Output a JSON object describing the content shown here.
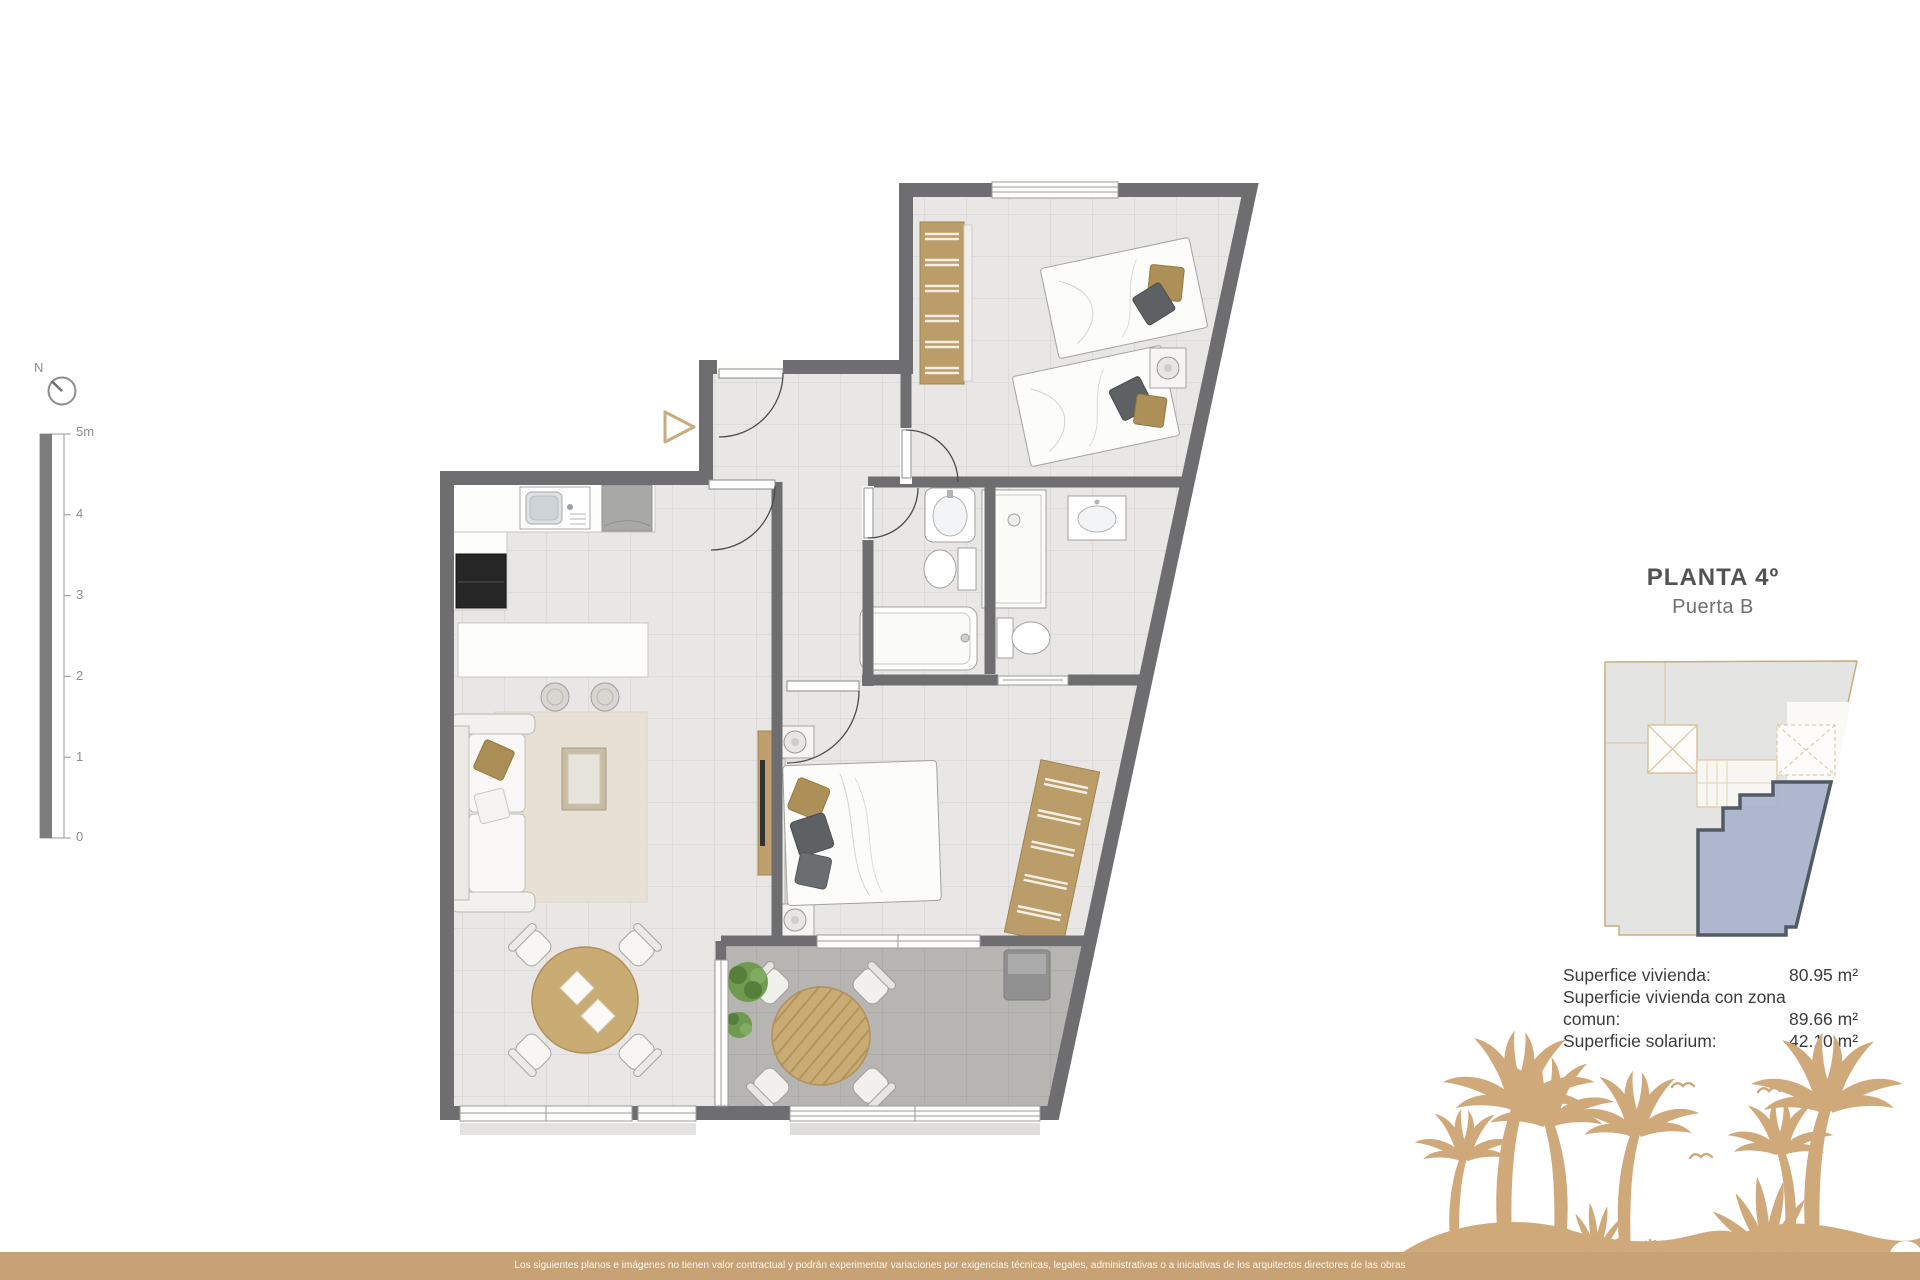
{
  "compass": {
    "label": "N"
  },
  "scale_bar": {
    "labels": [
      "5m",
      "4",
      "3",
      "2",
      "1",
      "0"
    ]
  },
  "plan_header": {
    "title": "PLANTA 4º",
    "subtitle": "Puerta B"
  },
  "areas": {
    "rows": [
      {
        "label": "Superfice vivienda:",
        "value": "80.95 m²"
      },
      {
        "label": "Superficie vivienda con zona comun:",
        "value": "89.66 m²"
      },
      {
        "label": "Superficie solarium:",
        "value": "42.10 m²"
      }
    ]
  },
  "footer": {
    "disclaimer": "Los siguientes planos e imágenes no tienen valor contractual y podrán experimentar variaciones por exigencias técnicas, legales, administrativas o a iniciativas de los arquitectos directores de las obras"
  },
  "colors": {
    "accent_tan": "#c9ab7e",
    "beach_tan": "#cfa97a",
    "footer_tan": "#c6a274",
    "wall_gray": "#6e6d6f",
    "highlight_unit_blue": "#a9b3cc",
    "highlight_unit_border": "#505b66"
  }
}
